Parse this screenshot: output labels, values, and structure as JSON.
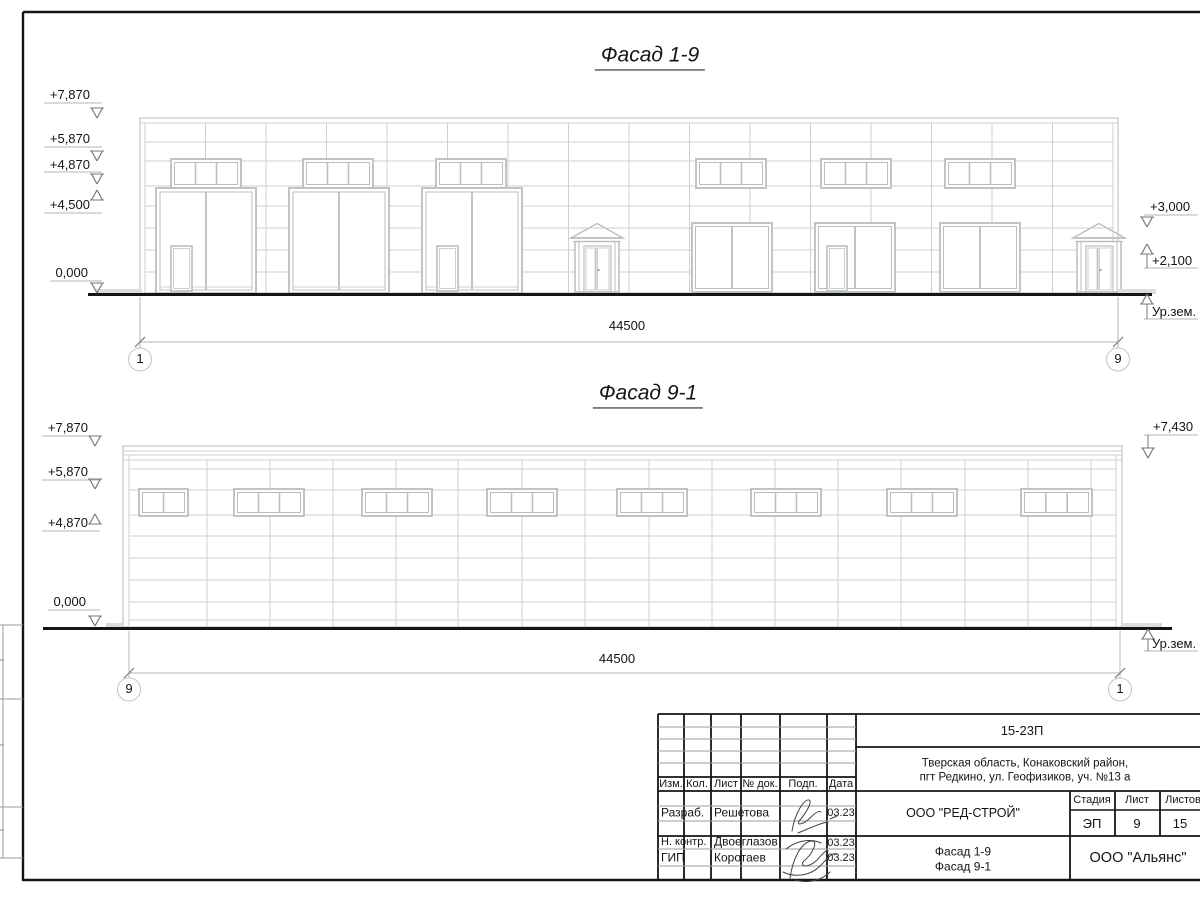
{
  "f1": {
    "title": "Фасад 1-9",
    "dim": "44500",
    "axis_left": "1",
    "axis_right": "9",
    "marks": {
      "m1": "+7,870",
      "m2": "+5,870",
      "m3": "+4,870",
      "m4": "+4,500",
      "m5": "0,000",
      "r1": "+3,000",
      "r2": "+2,100",
      "ground": "Ур.зем."
    }
  },
  "f2": {
    "title": "Фасад 9-1",
    "dim": "44500",
    "axis_left": "9",
    "axis_right": "1",
    "marks": {
      "m1": "+7,870",
      "m2": "+5,870",
      "m3": "+4,870",
      "m4": "0,000",
      "r1": "+7,430",
      "ground": "Ур.зем."
    }
  },
  "title_block": {
    "code": "15-23П",
    "address_line1": "Тверская область, Конаковский район,",
    "address_line2": "пгт Редкино, ул. Геофизиков, уч. №13 а",
    "col_izm": "Изм.",
    "col_kol": "Кол.",
    "col_list": "Лист",
    "col_doc": "№ док.",
    "col_podp": "Подп.",
    "col_data": "Дата",
    "rows": [
      {
        "role": "Разраб.",
        "name": "Решетова",
        "date": "03.23"
      },
      {
        "role": "Н. контр.",
        "name": "Двоеглазов",
        "date": "03.23"
      },
      {
        "role": "ГИП",
        "name": "Коротаев",
        "date": "03.23"
      }
    ],
    "company": "ООО \"РЕД-СТРОЙ\"",
    "stage_label": "Стадия",
    "sheet_label": "Лист",
    "sheets_label": "Листов",
    "stage": "ЭП",
    "sheet_no": "9",
    "sheets_total": "15",
    "doc_name_line1": "Фасад 1-9",
    "doc_name_line2": "Фасад 9-1",
    "contractor": "ООО \"Альянс\""
  }
}
